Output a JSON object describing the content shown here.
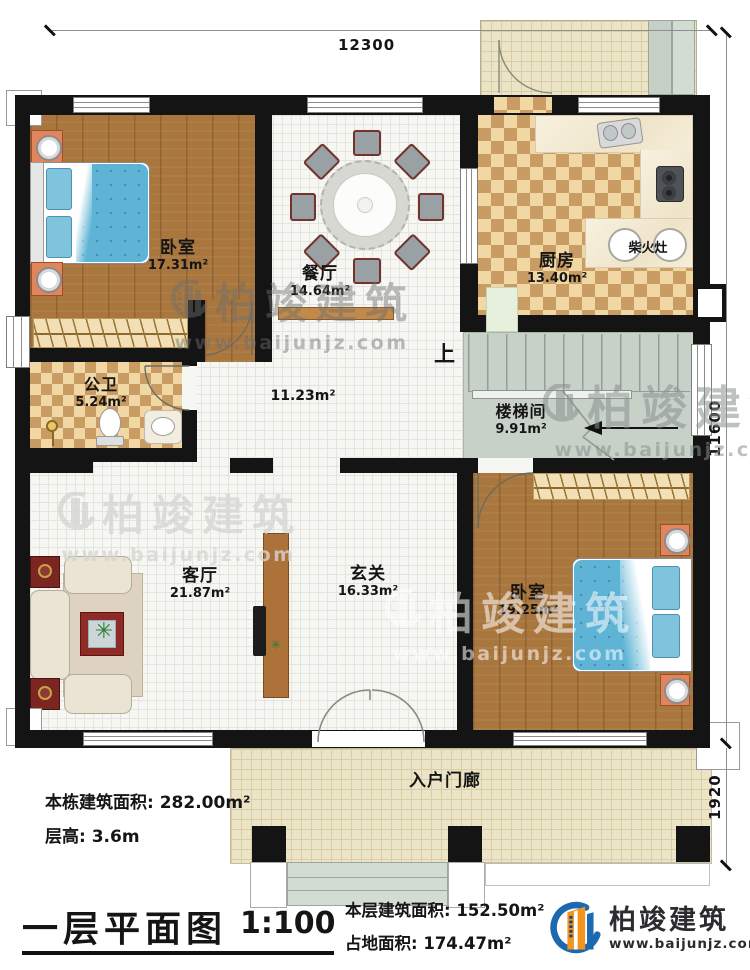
{
  "plan": {
    "dimensions": {
      "top": "12300",
      "right_main": "11600",
      "right_porch": "1920"
    },
    "rooms": [
      {
        "name": "卧室",
        "area": "17.31m²"
      },
      {
        "name": "餐厅",
        "area": "14.64m²"
      },
      {
        "name": "厨房",
        "area": "13.40m²"
      },
      {
        "name": "公卫",
        "area": "5.24m²"
      },
      {
        "name": "楼梯间",
        "area": "9.91m²"
      },
      {
        "name": "客厅",
        "area": "21.87m²"
      },
      {
        "name": "玄关",
        "area": "16.33m²"
      },
      {
        "name": "卧室",
        "area": "19.25m²"
      },
      {
        "name": "入户门廊",
        "area": ""
      },
      {
        "name": "",
        "area": "11.23m²"
      }
    ],
    "labels": {
      "stove": "柴火灶",
      "stairs_up": "上"
    }
  },
  "annotations": {
    "building_area": "本栋建筑面积: 282.00m²",
    "floor_height": "层高: 3.6m"
  },
  "titleblock": {
    "title": "一层平面图",
    "scale": "1:100",
    "floor_area": "本层建筑面积: 152.50m²",
    "footprint_area": "占地面积: 174.47m²"
  },
  "brand": {
    "name": "柏竣建筑",
    "website": "www.baijunjz.com"
  },
  "colors": {
    "wall": "#141414",
    "wood_floor": "#a9763e",
    "checker_light": "#f0d7a4",
    "checker_dark": "#c99c63",
    "tile": "#f6f6f3",
    "porch_tile": "#ece4c6",
    "stair_grey": "#c8d1c8",
    "bed_blue": "#5fb4d6",
    "logo_blue": "#1b6ab1",
    "logo_orange": "#f2951f"
  }
}
